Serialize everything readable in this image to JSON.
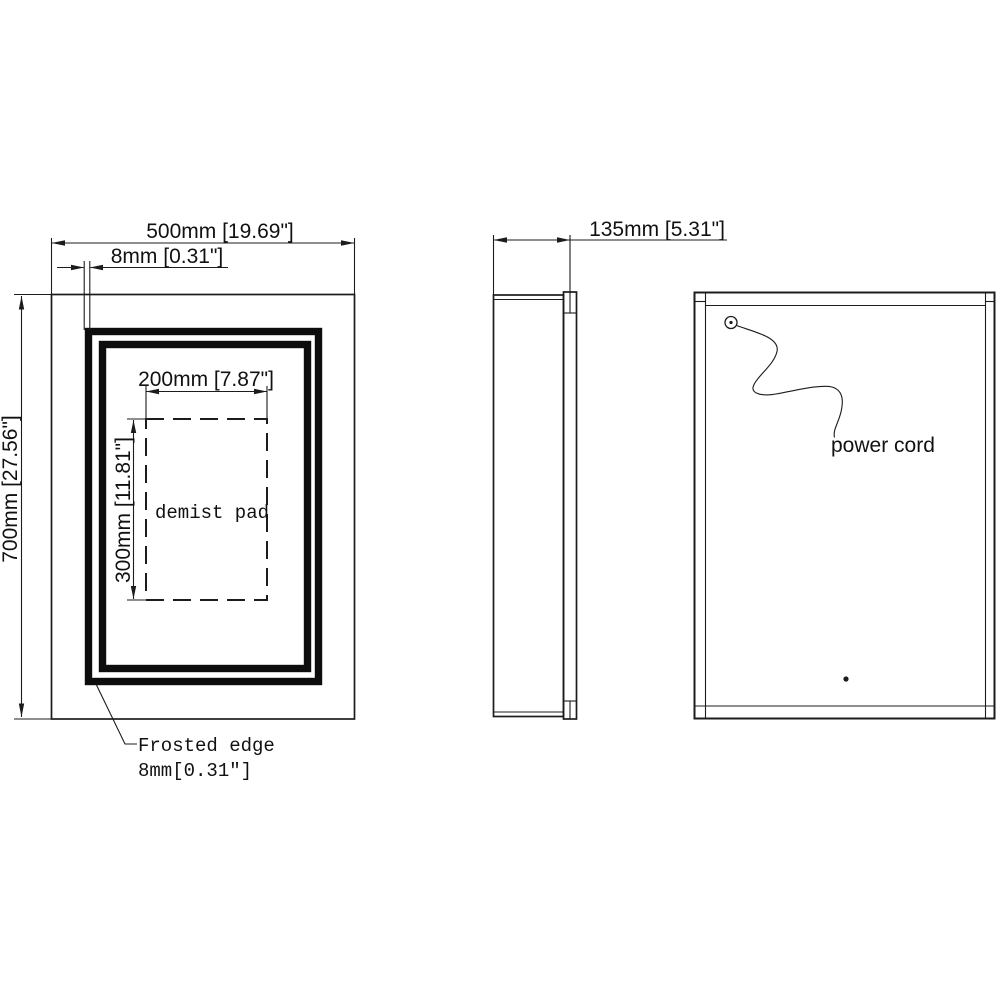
{
  "drawing": {
    "title": "mirror-cabinet-technical-drawing",
    "front_view": {
      "width_dim": "500mm [19.69\"]",
      "edge_dim": "8mm [0.31\"]",
      "height_dim": "700mm [27.56\"]",
      "pad_width_dim": "200mm [7.87\"]",
      "pad_height_dim": "300mm [11.81\"]",
      "pad_label": "demist pad",
      "frosted_edge_label": "Frosted edge",
      "frosted_edge_size": "8mm[0.31″]"
    },
    "side_view": {
      "depth_dim": "135mm [5.31\"]"
    },
    "back_view": {
      "power_cord_label": "power cord"
    },
    "colors": {
      "line": "#1c1c1c",
      "background": "#ffffff"
    }
  }
}
